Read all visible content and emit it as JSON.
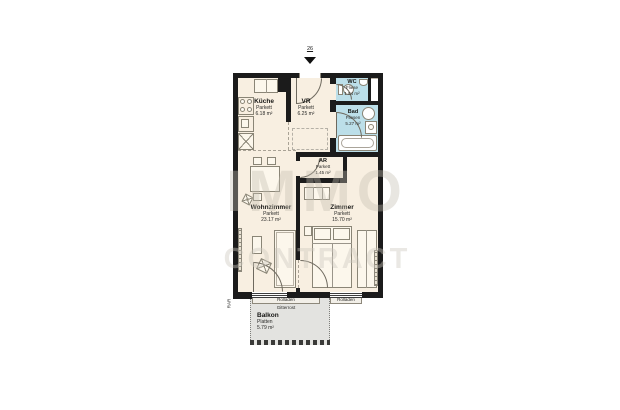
{
  "plan": {
    "entrance_number": "26",
    "watermark": {
      "line1": "IMMO",
      "line2": "CONTRACT"
    },
    "rooms": {
      "kueche": {
        "name": "Küche",
        "floor": "Parkett",
        "area": "6.18 m²"
      },
      "vr": {
        "name": "VR",
        "floor": "Parkett",
        "area": "6.25 m²"
      },
      "wc": {
        "name": "WC",
        "floor": "Fliese",
        "area": "1.84 m²"
      },
      "bad": {
        "name": "Bad",
        "floor": "Fliesen",
        "area": "5.27 m²"
      },
      "ar": {
        "name": "AR",
        "floor": "Parkett",
        "area": "1.45 m²"
      },
      "wohnzimmer": {
        "name": "Wohnzimmer",
        "floor": "Parkett",
        "area": "23.17 m²"
      },
      "zimmer": {
        "name": "Zimmer",
        "floor": "Parkett",
        "area": "15.70 m²"
      },
      "balkon": {
        "name": "Balkon",
        "floor": "Platten",
        "area": "5.79 m²"
      }
    },
    "annotations": {
      "rolladen_door": "Rolladen",
      "gitterrost": "Gitterrost",
      "rolladen_window": "Rolladen",
      "rar": "RAR"
    },
    "colors": {
      "wall": "#1b1b1b",
      "floor": "#f8efe1",
      "wet_room": "#bcdfe9",
      "balcony": "#e3e3e0",
      "watermark": "#d8d4c9"
    }
  }
}
